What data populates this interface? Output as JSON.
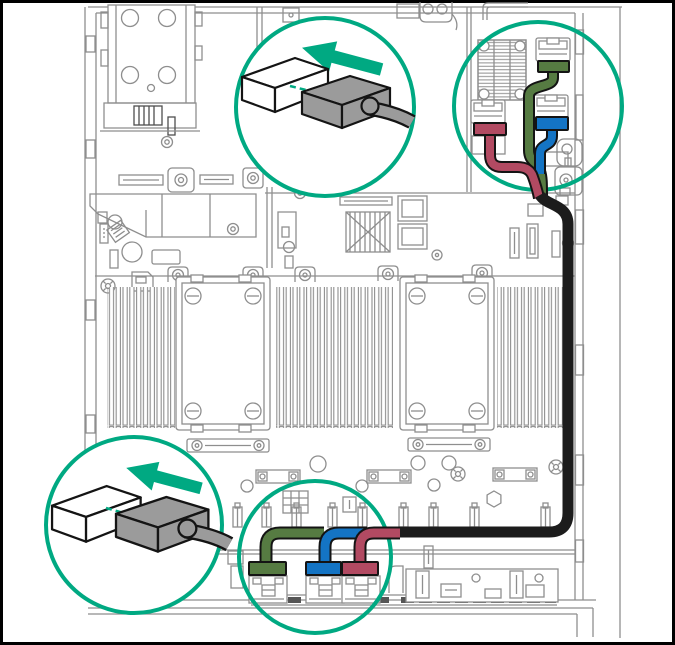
{
  "diagram": {
    "kind": "server-internal-cabling-diagram",
    "subject": "Top view of a 2U server chassis showing cable routing from system board ports to the front drive backplane",
    "visible_text": "",
    "background": "#FFFFFF",
    "frame_color": "#000000"
  },
  "colors": {
    "accent": "#00A982",
    "line": "#8E8E8E",
    "line_dark": "#4E4E4E",
    "outline": "#141414",
    "white": "#FFFFFF",
    "cable_green": "#567B42",
    "cable_blue": "#1474C4",
    "cable_red": "#B24A62",
    "cable_black": "#1C1C1C",
    "plug_gray": "#9B9B9B"
  },
  "callouts": [
    {
      "id": "top-detail-bubble",
      "kind": "zoom-bubble",
      "shows": "cable plug pulled away from a port",
      "icon": "arrow-up-left-icon"
    },
    {
      "id": "riser-ports-ring",
      "kind": "highlight-ring",
      "shows": "red, green and blue cable connectors seated beside a finned heatsink"
    },
    {
      "id": "front-detail-bubble",
      "kind": "zoom-bubble",
      "shows": "cable plug pulled away from a port",
      "icon": "arrow-up-left-icon"
    },
    {
      "id": "backplane-ports-ring",
      "kind": "highlight-ring",
      "shows": "green, blue and red cable connectors seated on the front backplane"
    }
  ],
  "cables": {
    "bundle_color": "black",
    "branch_colors": [
      "green",
      "blue",
      "red"
    ],
    "route": "from three system-board ports at top right, down the right chassis wall, across the front, branching to three backplane ports"
  },
  "components": [
    "psu-cage",
    "pcie-riser",
    "dimm-banks",
    "cpu-socket-1",
    "cpu-socket-2",
    "heatsink",
    "front-backplane",
    "chassis-walls"
  ]
}
